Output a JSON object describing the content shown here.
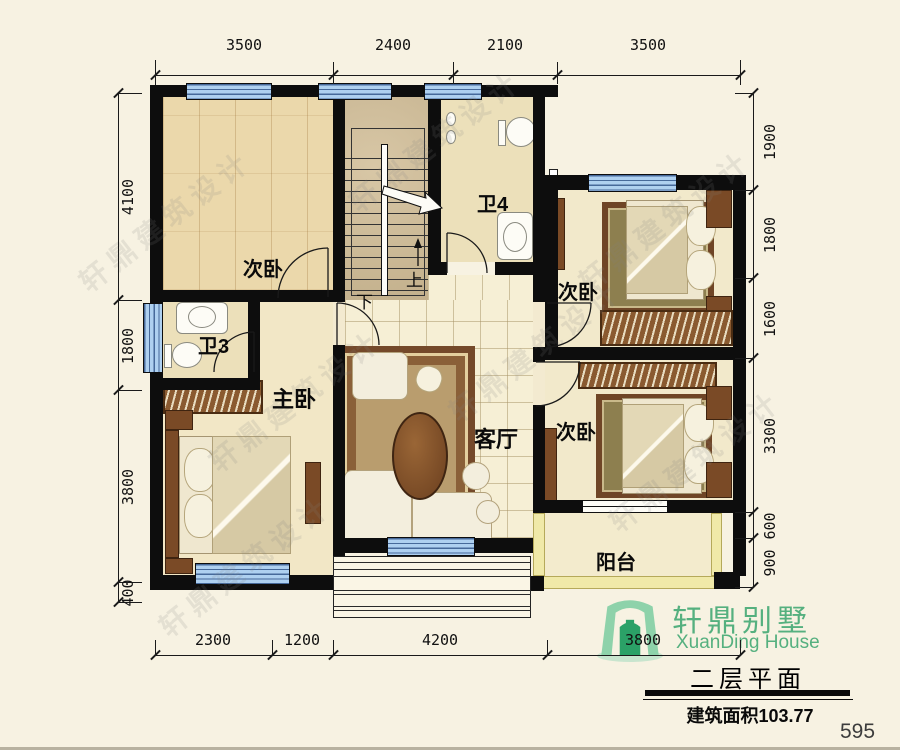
{
  "page": {
    "number": "595"
  },
  "watermark": "轩鼎建筑设计",
  "title_block": {
    "brand_cn": "轩鼎别墅",
    "brand_en": "XuanDing House",
    "plan_title": "二层平面",
    "area_text": "建筑面积103.77"
  },
  "rooms": {
    "bedroom_top_left": "次卧",
    "bedroom_right_upper": "次卧",
    "bedroom_right_lower": "次卧",
    "master_bedroom": "主卧",
    "living_room": "客厅",
    "bathroom_3": "卫3",
    "bathroom_4": "卫4",
    "balcony": "阳台",
    "stair_up": "上",
    "stair_down": "下"
  },
  "dimensions": {
    "top": [
      "3500",
      "2400",
      "2100",
      "3500"
    ],
    "bottom": [
      "2300",
      "1200",
      "4200",
      "3800"
    ],
    "left": [
      "4100",
      "1800",
      "3800",
      "400"
    ],
    "right": [
      "1900",
      "1800",
      "1600",
      "3300",
      "600",
      "900"
    ]
  },
  "colors": {
    "paper": "#f7f2e2",
    "wall": "#0d0d0d",
    "window_blue": "#a9ccee",
    "logo_green": "#55b07f"
  }
}
